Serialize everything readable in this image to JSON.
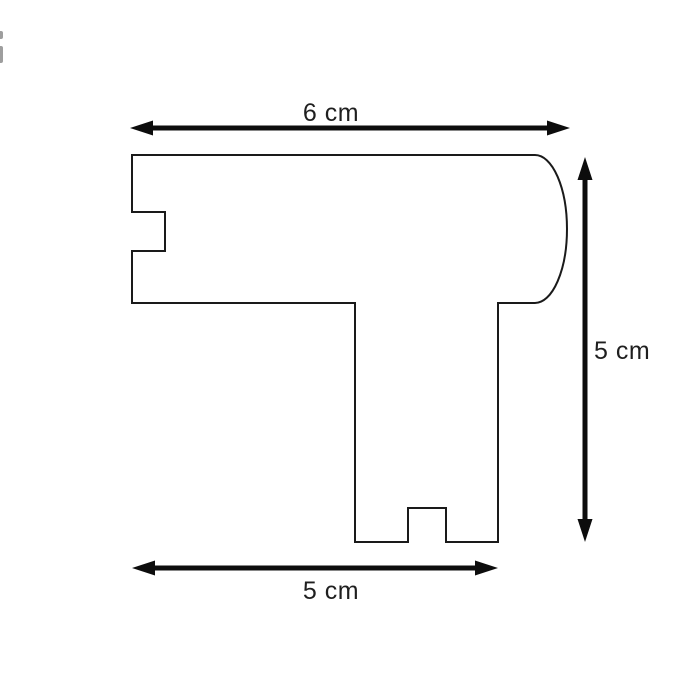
{
  "drawing": {
    "background_color": "#ffffff",
    "outline_color": "#1a1a1a",
    "arrow_color": "#0d0d0d",
    "text_color": "#1f1f1f",
    "artifact_color": "#9e9e9e",
    "shape_name": "molding-profile-cross-section",
    "dimensions": {
      "top_width": {
        "label": "6 cm"
      },
      "right_height": {
        "label": "5 cm"
      },
      "bottom_width": {
        "label": "5 cm"
      }
    }
  }
}
